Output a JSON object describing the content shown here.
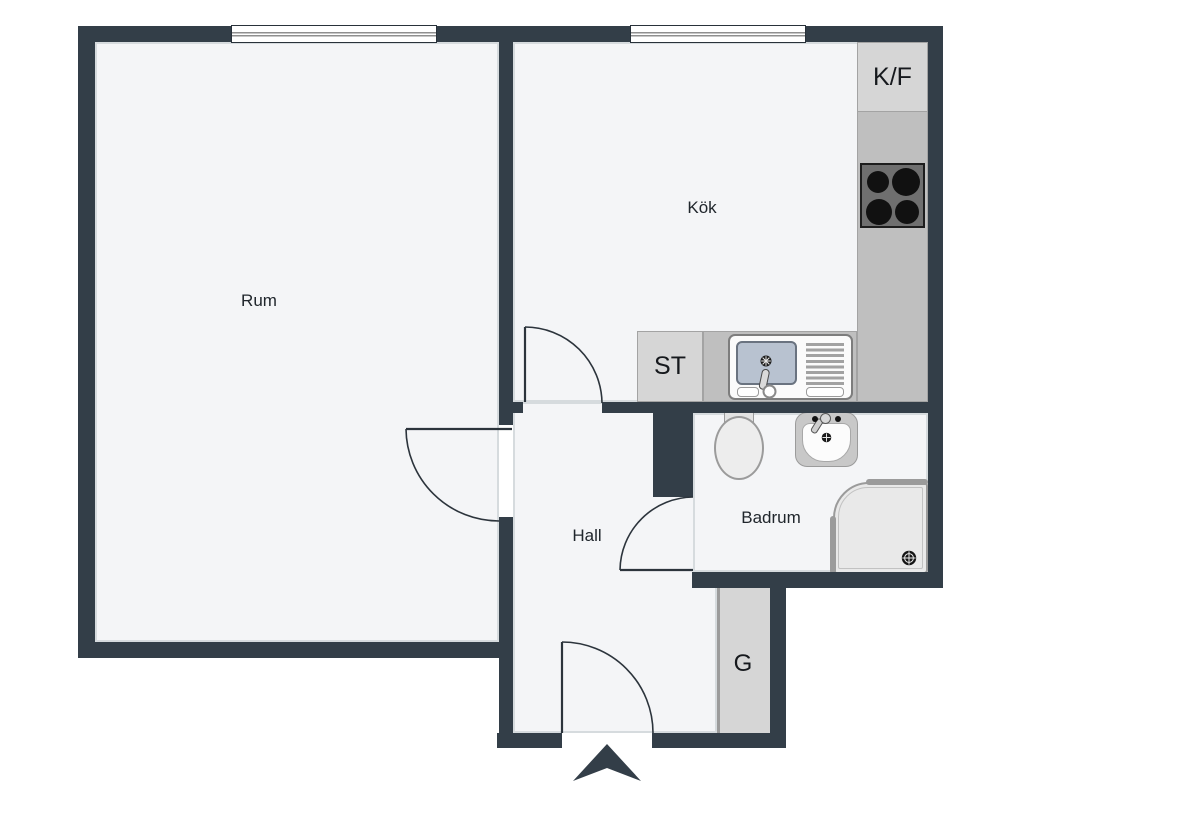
{
  "plan": {
    "rooms": [
      {
        "id": "rum",
        "label": "Rum"
      },
      {
        "id": "kok",
        "label": "Kök"
      },
      {
        "id": "hall",
        "label": "Hall"
      },
      {
        "id": "badrum",
        "label": "Badrum"
      }
    ],
    "fixtures": {
      "fridge_freezer": "K/F",
      "cleaning_closet": "ST",
      "wardrobe": "G"
    },
    "icons": {
      "entry_arrow": "chevron-up"
    },
    "colors": {
      "wall": "#333e48",
      "floor": "#f4f5f7",
      "counter": "#bfbfbf",
      "appliance": "#d6d6d6",
      "sink_basin": "#b8c2d0",
      "stove": "#6f6f6f",
      "door": "#2c343c"
    }
  }
}
